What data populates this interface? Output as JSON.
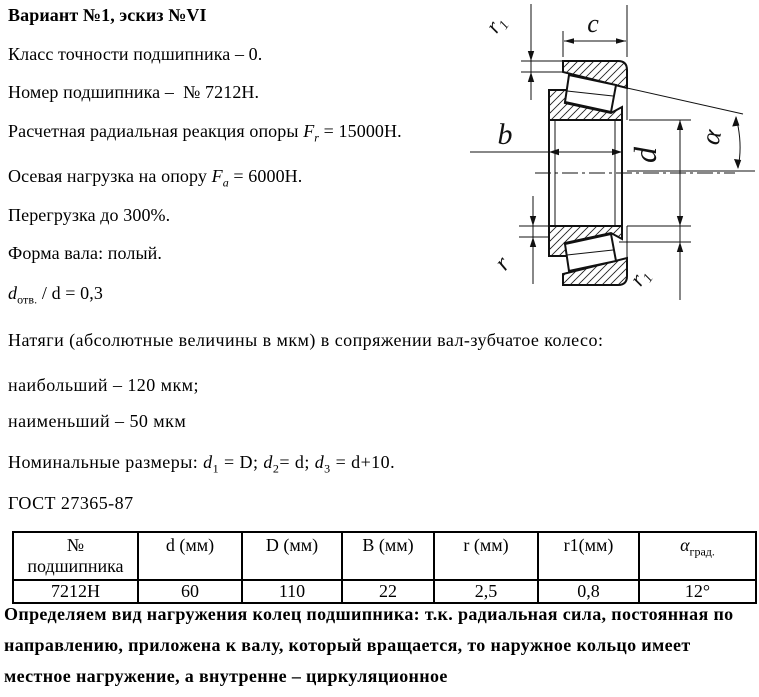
{
  "title": "Вариант №1, эскиз №VI",
  "specs": {
    "accuracy": {
      "text": "Класс точности подшипника – 0."
    },
    "number": {
      "text": "Номер подшипника –  № 7212Н."
    },
    "radial": {
      "prefix": "Расчетная радиальная реакция опоры ",
      "var": "F",
      "sub": "r",
      "suffix": " = 15000Н."
    },
    "axial": {
      "prefix": "Осевая нагрузка на опору ",
      "var": "F",
      "sub": "a",
      "suffix": " = 6000Н."
    },
    "overload": {
      "text": "Перегрузка до 300%."
    },
    "shaft": {
      "text": "Форма вала: полый."
    },
    "dratio": {
      "var": "d",
      "sub": "отв.",
      "suffix": " / d = 0,3"
    }
  },
  "interference": {
    "line1": "Натяги (абсолютные величины в мкм) в сопряжении вал-зубчатое колесо:",
    "line2": "наибольший – 120 мкм;",
    "line3": "наименьший – 50 мкм"
  },
  "nominal": {
    "label": "Номинальные размеры: ",
    "v1": "d",
    "s1": "1",
    "m1": " = D; ",
    "v2": "d",
    "s2": "2",
    "m2": "= d; ",
    "v3": "d",
    "s3": "3",
    "m3": " = d+10."
  },
  "gost": "ГОСТ 27365-87",
  "table": {
    "header": {
      "col1_line1": "№",
      "col1_line2": "подшипника",
      "col2": "d (мм)",
      "col3": "D (мм)",
      "col4": "B (мм)",
      "col5": "r (мм)",
      "col6": "r1(мм)",
      "col7_var": "α",
      "col7_sub": "град."
    },
    "row": {
      "bearing_no": "7212Н",
      "d": "60",
      "D": "110",
      "B": "22",
      "r": "2,5",
      "r1": "0,8",
      "alpha": "12°"
    }
  },
  "conclusion": {
    "line1": "Определяем вид нагружения колец подшипника: т.к. радиальная сила, постоянная по",
    "line2": "направлению, приложена к валу, который вращается, то наружное кольцо имеет",
    "line3": "местное нагружение, а внутренне – циркуляционное"
  },
  "drawing": {
    "labels": {
      "c": "c",
      "b": "b",
      "d": "d",
      "alpha": "α",
      "r": "r",
      "r1_var": "r",
      "r1_sub": "1"
    }
  }
}
